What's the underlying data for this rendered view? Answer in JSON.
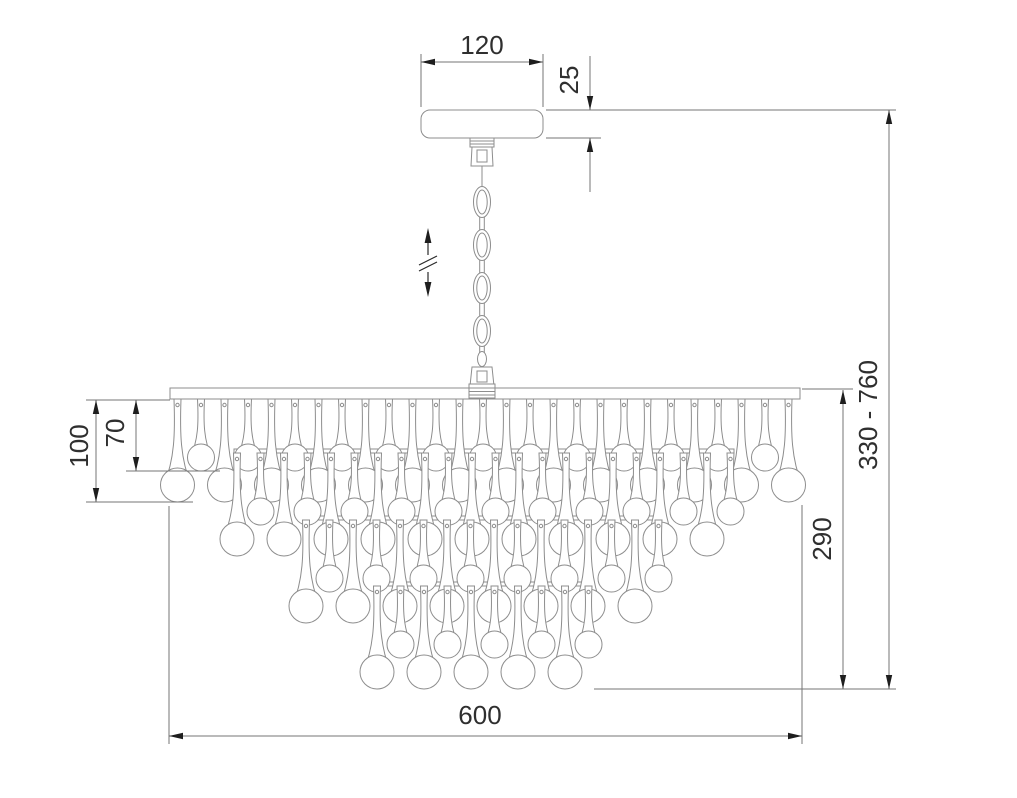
{
  "drawing": {
    "title": "chandelier-dimension-drawing",
    "colors": {
      "background": "#ffffff",
      "geometry_line": "#8d8d8d",
      "dimension_line": "#757575",
      "arrow": "#1e1e1e",
      "text": "#2f2f2f"
    },
    "dimensions": {
      "canopy_width": "120",
      "canopy_height": "25",
      "overall_height": "330 - 760",
      "body_height": "290",
      "long_drop": "100",
      "short_drop": "70",
      "body_width": "600"
    },
    "chandelier": {
      "chain_links": 4,
      "spacing": 23.5,
      "long": {
        "len": 103,
        "r": 17
      },
      "short": {
        "len": 72,
        "r": 13.5
      },
      "tiers": [
        {
          "attach_y": 399,
          "x_start": 177.5,
          "count": 27,
          "rail": null
        },
        {
          "attach_y": 453,
          "x_start": 237,
          "count": 22,
          "rail": {
            "x": 234,
            "y": 449,
            "w": 500
          }
        },
        {
          "attach_y": 520,
          "x_start": 306,
          "count": 16,
          "rail": {
            "x": 303,
            "y": 516,
            "w": 359
          }
        },
        {
          "attach_y": 586,
          "x_start": 377,
          "count": 10,
          "rail": {
            "x": 374,
            "y": 582,
            "w": 218
          }
        }
      ]
    }
  }
}
